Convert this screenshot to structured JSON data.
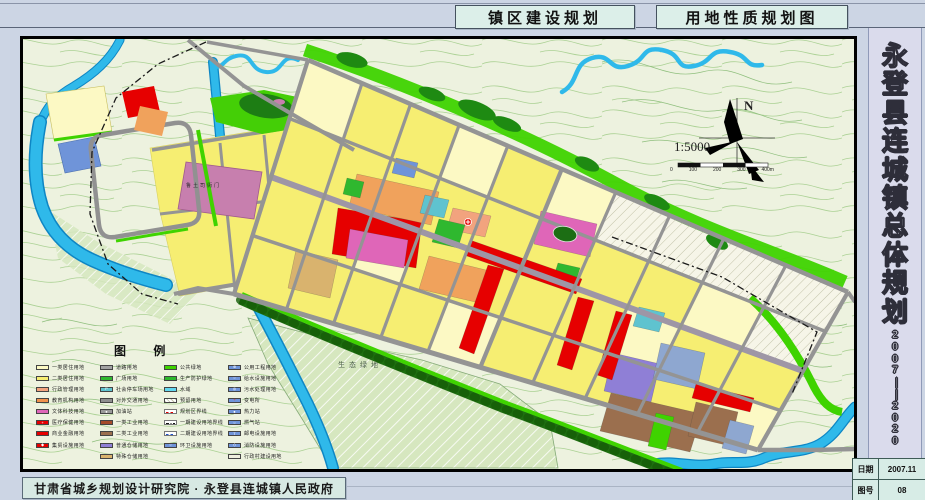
{
  "header": {
    "title_left": "镇区建设规划",
    "title_right": "用地性质规划图"
  },
  "side_panel": {
    "title": "永登县连城镇总体规划",
    "years": "2007——2020",
    "info_rows": [
      {
        "label": "日期",
        "value": "2007.11"
      },
      {
        "label": "图号",
        "value": "08"
      }
    ]
  },
  "footer": {
    "credit": "甘肃省城乡规划设计研究院 · 永登县连城镇人民政府"
  },
  "map": {
    "north_label": "N",
    "scale_text": "1:5000",
    "scale_ticks": [
      "0",
      "100",
      "200",
      "300",
      "400m"
    ],
    "labels": {
      "heritage": "鲁土司衙门",
      "eco": "生态绿地"
    },
    "palette": {
      "Y1": "#fcf9c4",
      "Y2": "#f6ee72",
      "ADM": "#f2a37e",
      "EDU": "#f0a25c",
      "MAG": "#df66b8",
      "MAG2": "#c77fae",
      "RED": "#e60000",
      "TEAL": "#5fc3cf",
      "MUN": "#6f94d9",
      "BLUG": "#8ea7d0",
      "STO": "#8f7fd6",
      "STO2": "#d9b36e",
      "IND1": "#a64b2a",
      "IND2": "#9b6f4e",
      "G1": "#3fd300",
      "G2": "#2eb82e",
      "GRN": "#2fb82f",
      "ROAD": "#949494",
      "WATER": "#2fb9ea",
      "RES": "hatch"
    }
  },
  "legend": {
    "title": "图  例",
    "columns": [
      {
        "items": [
          {
            "label": "一类居住用地",
            "color": "#fcf9c4"
          },
          {
            "label": "二类居住用地",
            "color": "#f6ee72"
          },
          {
            "label": "行政管理用地",
            "color": "#f2a37e"
          },
          {
            "label": "教育机构用地",
            "color": "#f0924d"
          },
          {
            "label": "文体科技用地",
            "color": "#df66b8"
          },
          {
            "label": "医疗保健用地",
            "color": "#e60000",
            "icon": "+"
          },
          {
            "label": "商业金融用地",
            "color": "#e60000"
          },
          {
            "label": "集贸设施用地",
            "color": "#e60000",
            "icon": "◆"
          }
        ]
      },
      {
        "items": [
          {
            "label": "道路用地",
            "color": "#a2a2a2"
          },
          {
            "label": "广场用地",
            "color": "#2fb82f",
            "texture": "dots"
          },
          {
            "label": "社会停车场用地",
            "color": "#5fc3cf",
            "icon": "P"
          },
          {
            "label": "对外交通用地",
            "color": "#8f8f8f"
          },
          {
            "label": "加油站",
            "color": "#9a9a9a",
            "icon": "●"
          },
          {
            "label": "一类工业用地",
            "color": "#a64b2a"
          },
          {
            "label": "二类工业用地",
            "color": "#9b6f4e"
          },
          {
            "label": "普通仓储用地",
            "color": "#8f7fd6"
          },
          {
            "label": "特殊仓储用地",
            "color": "#d9b36e"
          }
        ]
      },
      {
        "items": [
          {
            "label": "公共绿地",
            "color": "#3fd300"
          },
          {
            "label": "生产防护绿地",
            "color": "#2eb82e"
          },
          {
            "label": "水域",
            "color": "#62d8f0"
          },
          {
            "label": "预留用地",
            "color": "#ffffff",
            "texture": "hatch"
          },
          {
            "label": "规划区界线",
            "line": "red-dash"
          },
          {
            "label": "一期建设用地界线",
            "line": "black-dashdot"
          },
          {
            "label": "二期建设用地界线",
            "line": "blue-dash"
          },
          {
            "label": "环卫设施用地",
            "color": "#6f94d9",
            "icon": "○"
          }
        ]
      },
      {
        "items": [
          {
            "label": "公用工程用地",
            "color": "#6f94d9",
            "icon": "⊕"
          },
          {
            "label": "给水设施用地",
            "color": "#6f94d9",
            "icon": "○"
          },
          {
            "label": "污水处理用地",
            "color": "#6f94d9",
            "icon": "◎"
          },
          {
            "label": "变电所",
            "color": "#6f94d9",
            "icon": "+",
            "icon_color": "#ff2222"
          },
          {
            "label": "热力站",
            "color": "#6f94d9",
            "icon": "●"
          },
          {
            "label": "燃气站",
            "color": "#6f94d9",
            "icon": "○"
          },
          {
            "label": "邮电设施用地",
            "color": "#6f94d9",
            "icon": "T"
          },
          {
            "label": "消防设施用地",
            "color": "#6f94d9",
            "icon": "◇"
          },
          {
            "label": "行政村建设用地",
            "color": "#eeeedd"
          }
        ]
      }
    ]
  }
}
